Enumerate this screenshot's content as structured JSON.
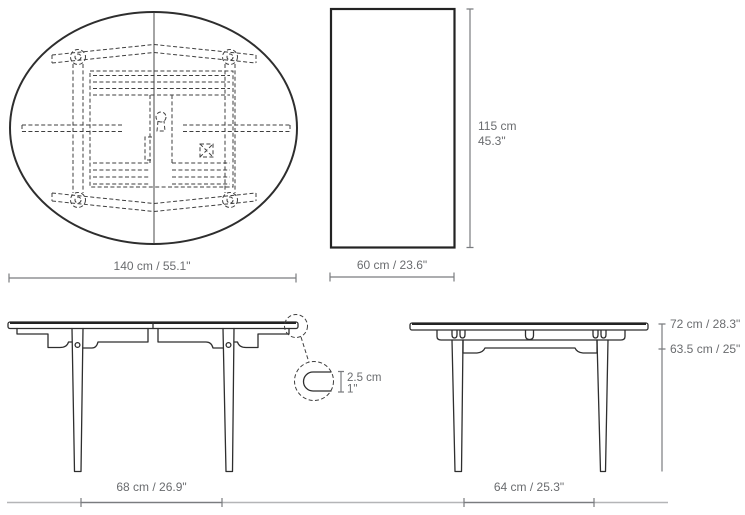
{
  "document": {
    "kind": "furniture dimension drawing",
    "views": [
      "tabletop-plan-view",
      "extension-leaf-view",
      "side-elevation",
      "end-elevation",
      "edge-thickness-detail"
    ]
  },
  "colors": {
    "background": "#ffffff",
    "drawing_line": "#2e2e2e",
    "dashed_frame_line": "#3f3f3f",
    "dimension_line": "#7a7c7f",
    "ground_line": "#b4b5b7",
    "label_text": "#6a6c6f"
  },
  "labels": {
    "plan_width": "140 cm / 55.1\"",
    "leaf_height_cm": "115 cm",
    "leaf_height_in": "45.3\"",
    "leaf_width": "60 cm / 23.6\"",
    "side_leg_span": "68 cm / 26.9\"",
    "end_leg_span": "64 cm / 25.3\"",
    "total_height": "72 cm / 28.3\"",
    "clearance_height": "63.5 cm / 25\"",
    "top_thickness_cm": "2.5 cm",
    "top_thickness_in": "1\""
  }
}
